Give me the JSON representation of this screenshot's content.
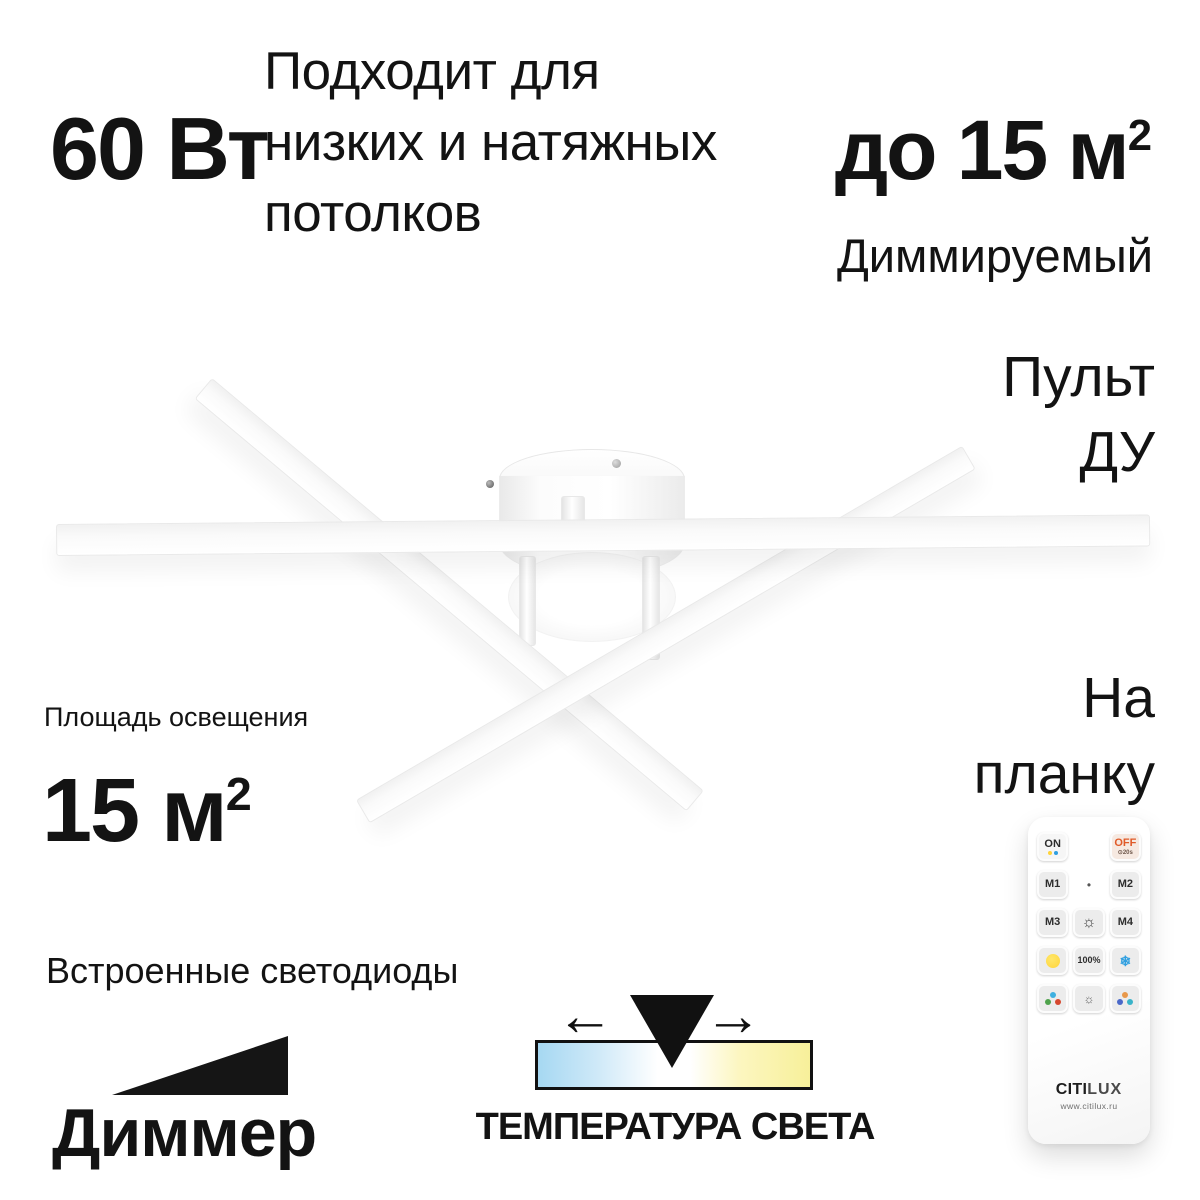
{
  "colors": {
    "text": "#131313",
    "cool_blue": "#a6d8f2",
    "warm_yellow": "#f7f09a",
    "off_orange": "#e05a28",
    "remote_warm": "#ffd43a",
    "remote_cold": "#2f9fe0"
  },
  "features": {
    "wattage": "60 Вт",
    "ceilings_lines": [
      "Подходит для",
      "низких и натяжных",
      "потолков"
    ],
    "max_area": {
      "text": "до 15 м",
      "sup": "2"
    },
    "dimmable": "Диммируемый",
    "remote_lines": [
      "Пульт",
      "ДУ"
    ],
    "mount_lines": [
      "На",
      "планку"
    ],
    "area_label": "Площадь освещения",
    "area_value": {
      "text": "15 м",
      "sup": "2"
    },
    "leds": "Встроенные светодиоды",
    "dimmer": "Диммер",
    "temperature": "ТЕМПЕРАТУРА СВЕТА"
  },
  "remote_control": {
    "on": "ON",
    "off": "OFF",
    "off_sub": "⊙20s",
    "m1": "M1",
    "m2": "M2",
    "m3": "M3",
    "m4": "M4",
    "dot": "•",
    "brightness_up_icon": "☼",
    "percent": "100%",
    "cold_icon": "❄",
    "brightness_down_icon": "☼",
    "brand_bold": "CITI",
    "brand_light": "LUX",
    "site": "www.citilux.ru"
  }
}
